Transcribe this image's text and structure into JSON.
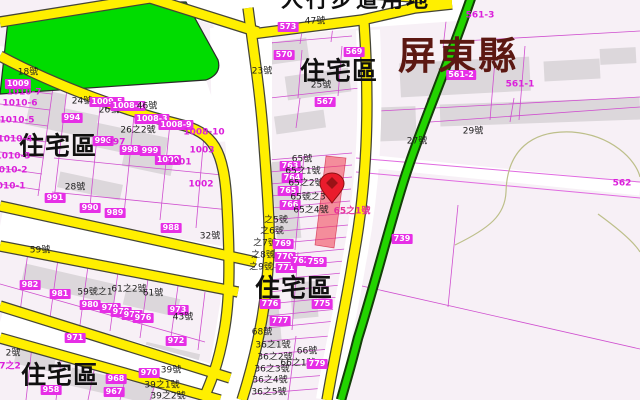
{
  "map": {
    "county_label": "屏東縣",
    "walkway_label": "人行步道用地",
    "zone_label": "住宅區",
    "marker": {
      "icon": "location-pin-icon",
      "x": 332,
      "y": 186
    },
    "colors": {
      "road_yellow": "#ffef00",
      "park_green": "#00dc00",
      "green_road": "#23d400",
      "parcel_line": "#cf4fcf",
      "label_box": "#e62ee6",
      "highlight_red": "rgba(242,60,80,0.55)",
      "county_text": "#5c1812",
      "ground": "#f7f0f6"
    },
    "labels": [
      {
        "t": "人行步道用地",
        "x": 356,
        "y": 1,
        "s": "rd"
      },
      {
        "t": "屏東縣",
        "x": 458,
        "y": 56,
        "s": "county"
      },
      {
        "t": "住宅區",
        "x": 58,
        "y": 146,
        "s": "zone"
      },
      {
        "t": "住宅區",
        "x": 339,
        "y": 71,
        "s": "zone"
      },
      {
        "t": "住宅區",
        "x": 294,
        "y": 288,
        "s": "zone"
      },
      {
        "t": "住宅區",
        "x": 60,
        "y": 375,
        "s": "zone"
      },
      {
        "t": "18號",
        "x": 28,
        "y": 73,
        "s": "b"
      },
      {
        "t": "1009",
        "x": 18,
        "y": 84,
        "s": "w"
      },
      {
        "t": "1010-7",
        "x": 24,
        "y": 93,
        "s": "m"
      },
      {
        "t": "1010-6",
        "x": 20,
        "y": 104,
        "s": "m"
      },
      {
        "t": "1010-5",
        "x": 17,
        "y": 121,
        "s": "m"
      },
      {
        "t": "1010-4",
        "x": 15,
        "y": 140,
        "s": "m"
      },
      {
        "t": "1010-3",
        "x": 13,
        "y": 157,
        "s": "m"
      },
      {
        "t": "1010-2",
        "x": 10,
        "y": 171,
        "s": "m"
      },
      {
        "t": "1010-1",
        "x": 8,
        "y": 187,
        "s": "m"
      },
      {
        "t": "24號",
        "x": 82,
        "y": 102,
        "s": "b"
      },
      {
        "t": "994",
        "x": 72,
        "y": 118,
        "s": "w"
      },
      {
        "t": "26號",
        "x": 109,
        "y": 111,
        "s": "b"
      },
      {
        "t": "1009-5",
        "x": 107,
        "y": 102,
        "s": "w"
      },
      {
        "t": "1008-2",
        "x": 128,
        "y": 106,
        "s": "w"
      },
      {
        "t": "46號",
        "x": 147,
        "y": 107,
        "s": "b"
      },
      {
        "t": "26之2號",
        "x": 138,
        "y": 131,
        "s": "b"
      },
      {
        "t": "1008-3",
        "x": 152,
        "y": 119,
        "s": "w"
      },
      {
        "t": "1008-9",
        "x": 176,
        "y": 125,
        "s": "w"
      },
      {
        "t": "1008-10",
        "x": 204,
        "y": 133,
        "s": "m"
      },
      {
        "t": "996",
        "x": 103,
        "y": 141,
        "s": "w"
      },
      {
        "t": "997",
        "x": 116,
        "y": 143,
        "s": "m"
      },
      {
        "t": "998",
        "x": 130,
        "y": 150,
        "s": "w"
      },
      {
        "t": "999",
        "x": 150,
        "y": 151,
        "s": "w"
      },
      {
        "t": "1000",
        "x": 168,
        "y": 160,
        "s": "w"
      },
      {
        "t": "1001",
        "x": 179,
        "y": 163,
        "s": "m"
      },
      {
        "t": "1003",
        "x": 202,
        "y": 151,
        "s": "m"
      },
      {
        "t": "1002",
        "x": 201,
        "y": 185,
        "s": "m"
      },
      {
        "t": "28號",
        "x": 75,
        "y": 188,
        "s": "b"
      },
      {
        "t": "991",
        "x": 55,
        "y": 198,
        "s": "w"
      },
      {
        "t": "990",
        "x": 90,
        "y": 208,
        "s": "w"
      },
      {
        "t": "989",
        "x": 115,
        "y": 213,
        "s": "w"
      },
      {
        "t": "988",
        "x": 171,
        "y": 228,
        "s": "w"
      },
      {
        "t": "32號",
        "x": 210,
        "y": 237,
        "s": "b"
      },
      {
        "t": "59號",
        "x": 40,
        "y": 251,
        "s": "b"
      },
      {
        "t": "982",
        "x": 30,
        "y": 285,
        "s": "w"
      },
      {
        "t": "981",
        "x": 60,
        "y": 294,
        "s": "w"
      },
      {
        "t": "59號之1",
        "x": 95,
        "y": 293,
        "s": "b"
      },
      {
        "t": "61之2號",
        "x": 129,
        "y": 290,
        "s": "b"
      },
      {
        "t": "61號",
        "x": 153,
        "y": 294,
        "s": "b"
      },
      {
        "t": "980",
        "x": 90,
        "y": 305,
        "s": "w"
      },
      {
        "t": "979",
        "x": 110,
        "y": 308,
        "s": "w"
      },
      {
        "t": "978",
        "x": 121,
        "y": 312,
        "s": "w"
      },
      {
        "t": "977",
        "x": 132,
        "y": 315,
        "s": "w"
      },
      {
        "t": "976",
        "x": 143,
        "y": 318,
        "s": "w"
      },
      {
        "t": "973",
        "x": 178,
        "y": 310,
        "s": "w"
      },
      {
        "t": "43號",
        "x": 183,
        "y": 318,
        "s": "b"
      },
      {
        "t": "972",
        "x": 176,
        "y": 341,
        "s": "w"
      },
      {
        "t": "971",
        "x": 75,
        "y": 338,
        "s": "w"
      },
      {
        "t": "2號",
        "x": 13,
        "y": 354,
        "s": "b"
      },
      {
        "t": "7之2",
        "x": 10,
        "y": 367,
        "s": "m"
      },
      {
        "t": "958",
        "x": 51,
        "y": 390,
        "s": "w"
      },
      {
        "t": "970",
        "x": 149,
        "y": 373,
        "s": "w"
      },
      {
        "t": "39號",
        "x": 171,
        "y": 371,
        "s": "b"
      },
      {
        "t": "39之1號",
        "x": 162,
        "y": 386,
        "s": "b"
      },
      {
        "t": "968",
        "x": 116,
        "y": 379,
        "s": "w"
      },
      {
        "t": "967",
        "x": 114,
        "y": 392,
        "s": "w"
      },
      {
        "t": "39之2號",
        "x": 168,
        "y": 397,
        "s": "b"
      },
      {
        "t": "573",
        "x": 288,
        "y": 27,
        "s": "w"
      },
      {
        "t": "47號",
        "x": 315,
        "y": 22,
        "s": "b"
      },
      {
        "t": "570",
        "x": 284,
        "y": 55,
        "s": "w"
      },
      {
        "t": "569",
        "x": 354,
        "y": 52,
        "s": "w"
      },
      {
        "t": "23號",
        "x": 262,
        "y": 72,
        "s": "b"
      },
      {
        "t": "25號",
        "x": 321,
        "y": 86,
        "s": "b"
      },
      {
        "t": "567",
        "x": 325,
        "y": 102,
        "s": "w"
      },
      {
        "t": "561-3",
        "x": 480,
        "y": 16,
        "s": "m"
      },
      {
        "t": "561-2",
        "x": 461,
        "y": 75,
        "s": "w"
      },
      {
        "t": "561-1",
        "x": 520,
        "y": 85,
        "s": "m"
      },
      {
        "t": "562",
        "x": 622,
        "y": 184,
        "s": "m"
      },
      {
        "t": "27號",
        "x": 417,
        "y": 142,
        "s": "b"
      },
      {
        "t": "29號",
        "x": 473,
        "y": 132,
        "s": "b"
      },
      {
        "t": "739",
        "x": 402,
        "y": 239,
        "s": "w"
      },
      {
        "t": "65號",
        "x": 302,
        "y": 160,
        "s": "b"
      },
      {
        "t": "763",
        "x": 290,
        "y": 166,
        "s": "w"
      },
      {
        "t": "65之1號",
        "x": 303,
        "y": 172,
        "s": "b"
      },
      {
        "t": "764",
        "x": 292,
        "y": 178,
        "s": "w"
      },
      {
        "t": "65之2號",
        "x": 306,
        "y": 184,
        "s": "b"
      },
      {
        "t": "765",
        "x": 288,
        "y": 191,
        "s": "w"
      },
      {
        "t": "65號之3",
        "x": 308,
        "y": 198,
        "s": "b"
      },
      {
        "t": "766",
        "x": 290,
        "y": 205,
        "s": "w"
      },
      {
        "t": "65之4號",
        "x": 311,
        "y": 211,
        "s": "b"
      },
      {
        "t": "65之1號",
        "x": 352,
        "y": 212,
        "s": "pk"
      },
      {
        "t": "之5號",
        "x": 276,
        "y": 221,
        "s": "b"
      },
      {
        "t": "之6號",
        "x": 272,
        "y": 232,
        "s": "b"
      },
      {
        "t": "之7號",
        "x": 265,
        "y": 244,
        "s": "b"
      },
      {
        "t": "769",
        "x": 283,
        "y": 244,
        "s": "w"
      },
      {
        "t": "之8號",
        "x": 263,
        "y": 256,
        "s": "b"
      },
      {
        "t": "770",
        "x": 285,
        "y": 257,
        "s": "w"
      },
      {
        "t": "之9號",
        "x": 261,
        "y": 268,
        "s": "b"
      },
      {
        "t": "771",
        "x": 286,
        "y": 268,
        "s": "w"
      },
      {
        "t": "762",
        "x": 301,
        "y": 261,
        "s": "w"
      },
      {
        "t": "759",
        "x": 316,
        "y": 262,
        "s": "w"
      },
      {
        "t": "776",
        "x": 270,
        "y": 304,
        "s": "w"
      },
      {
        "t": "775",
        "x": 322,
        "y": 304,
        "s": "w"
      },
      {
        "t": "777",
        "x": 280,
        "y": 321,
        "s": "w"
      },
      {
        "t": "68號",
        "x": 262,
        "y": 333,
        "s": "b"
      },
      {
        "t": "36之1號",
        "x": 273,
        "y": 346,
        "s": "b"
      },
      {
        "t": "36之2號",
        "x": 275,
        "y": 358,
        "s": "b"
      },
      {
        "t": "36之3號",
        "x": 272,
        "y": 370,
        "s": "b"
      },
      {
        "t": "36之4號",
        "x": 270,
        "y": 381,
        "s": "b"
      },
      {
        "t": "36之5號",
        "x": 269,
        "y": 393,
        "s": "b"
      },
      {
        "t": "66號",
        "x": 307,
        "y": 352,
        "s": "b"
      },
      {
        "t": "66之1號",
        "x": 298,
        "y": 364,
        "s": "b"
      },
      {
        "t": "779",
        "x": 317,
        "y": 364,
        "s": "w"
      }
    ]
  }
}
